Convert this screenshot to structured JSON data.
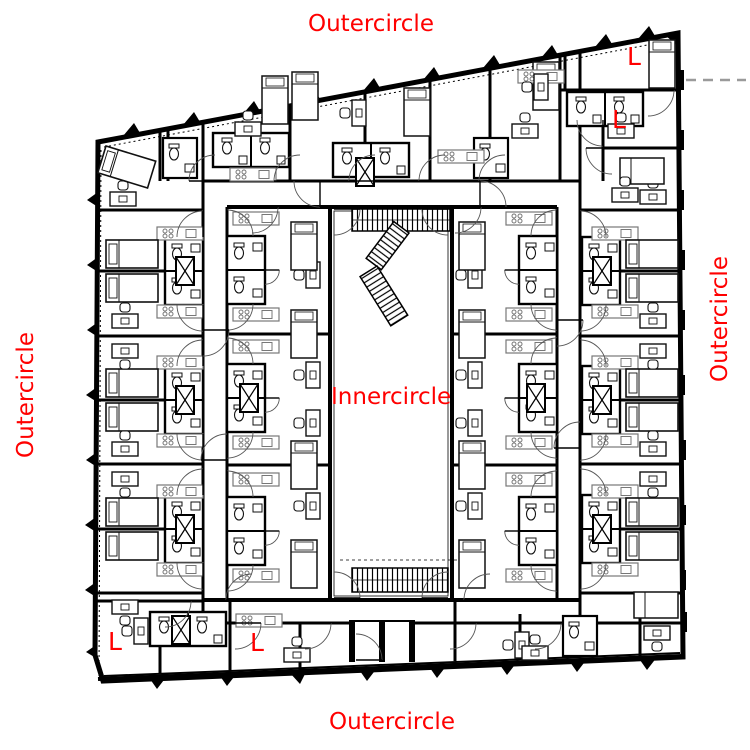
{
  "plan": {
    "title": "apartment-building-floor-plan",
    "labels": {
      "top": "Outercircle",
      "bottom": "Outercircle",
      "left": "Outercircle",
      "right": "Outercircle",
      "center": "Innercircle",
      "l_top_right_upper": "L",
      "l_top_right_lower": "L",
      "l_bottom_left_west": "L",
      "l_bottom_left_east": "L"
    },
    "colors": {
      "label_red": "#ff0000",
      "plan_black": "#000000",
      "background": "#ffffff",
      "reference_dash_gray": "#9a9a9a"
    }
  }
}
